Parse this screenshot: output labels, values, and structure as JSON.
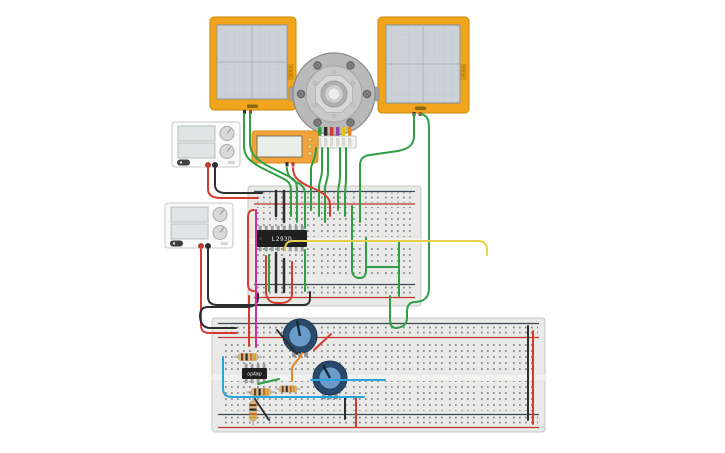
{
  "colors": {
    "canvas_bg": "#ffffff",
    "oscilloscope_frame": "#f0a51d",
    "oscilloscope_screen": "#ccd3d8",
    "lcd_frame": "#f2a33c",
    "lcd_screen": "#e9eee9",
    "breadboard": "#e9e9e7",
    "rail_positive": "#c0392b",
    "rail_negative": "#3d4852",
    "ic_body": "#1f1f1f",
    "pot_outer": "#2a4a6b",
    "pot_inner": "#6b9cc9",
    "resistor_body": "#d9b98a",
    "resistor_bands": [
      "#7a3e1d",
      "#2b2b2b",
      "#cf6a1e",
      "#c9a227"
    ],
    "motor_body": "#b9b9b9",
    "power_supply_body": "#fafafa",
    "motor_wire_stubs": [
      "#2f9e44",
      "#2b2b2b",
      "#d6392e",
      "#8e44ad",
      "#e8c50a",
      "#e8871e"
    ]
  },
  "wire_colors": {
    "green": "#2f9e44",
    "red": "#d6392e",
    "black": "#2e2e2e",
    "yellow": "#e6cf4b",
    "pink": "#cf2f9a",
    "orange": "#e8871e",
    "blue": "#2aa5dc"
  },
  "ics": {
    "motor_driver": {
      "label": "L293D"
    },
    "opamp": {
      "label": "opAmp"
    }
  },
  "components": {
    "list": "oscilloscope-left, oscilloscope-right, encoder-motor, lcd-display, power-supply-1, power-supply-2, breadboard-small, breadboard-large, motor-driver-ic, opamp-ic, potentiometer-1, potentiometer-2, resistor-1, resistor-2, resistor-3, resistor-4"
  }
}
